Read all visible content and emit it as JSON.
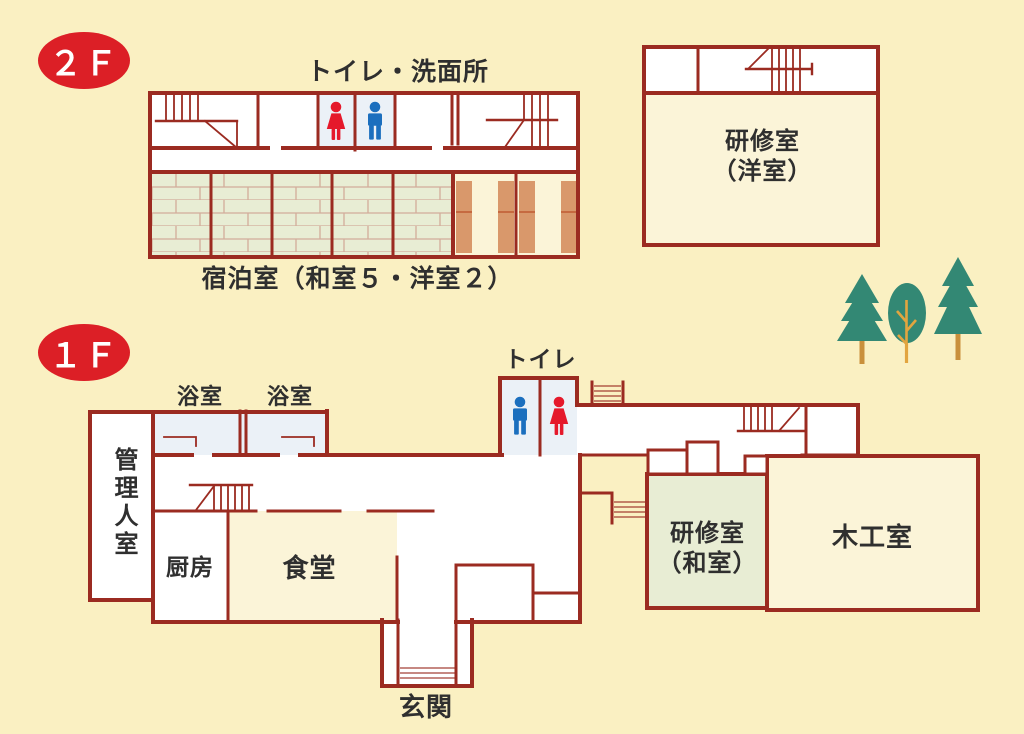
{
  "palette": {
    "background": "#faf0c2",
    "wall": "#9b2b21",
    "room_cream": "#fbf4d8",
    "room_green": "#e8edd4",
    "room_blue": "#ebf1f7",
    "tatami_line": "#d2ac9a",
    "bed": "#d9986b",
    "bed_line": "#c05a33",
    "badge_red": "#dc1f26",
    "text": "#2f2f2f",
    "male_blue": "#1b6fbe",
    "female_red": "#e5192b",
    "tree_green": "#338874",
    "trunk_brown": "#c9903c",
    "branch_orange": "#e2a53f"
  },
  "floor2": {
    "badge": "２Ｆ",
    "toilet_washroom_label": "トイレ・洗面所",
    "guest_rooms_label": "宿泊室（和室５・洋室２）",
    "annex_room_line1": "研修室",
    "annex_room_line2": "（洋室）"
  },
  "floor1": {
    "badge": "１Ｆ",
    "toilet_label": "トイレ",
    "bath_label_1": "浴室",
    "bath_label_2": "浴室",
    "caretaker_label": "管理人室",
    "kitchen_label": "厨房",
    "dining_label": "食堂",
    "training_room_line1": "研修室",
    "training_room_line2": "（和室）",
    "woodwork_label": "木工室",
    "entrance_label": "玄関"
  },
  "icons": {
    "male_restroom": "male-pictogram",
    "female_restroom": "female-pictogram",
    "trees": [
      "pine-tree",
      "round-tree",
      "pine-tree"
    ]
  }
}
